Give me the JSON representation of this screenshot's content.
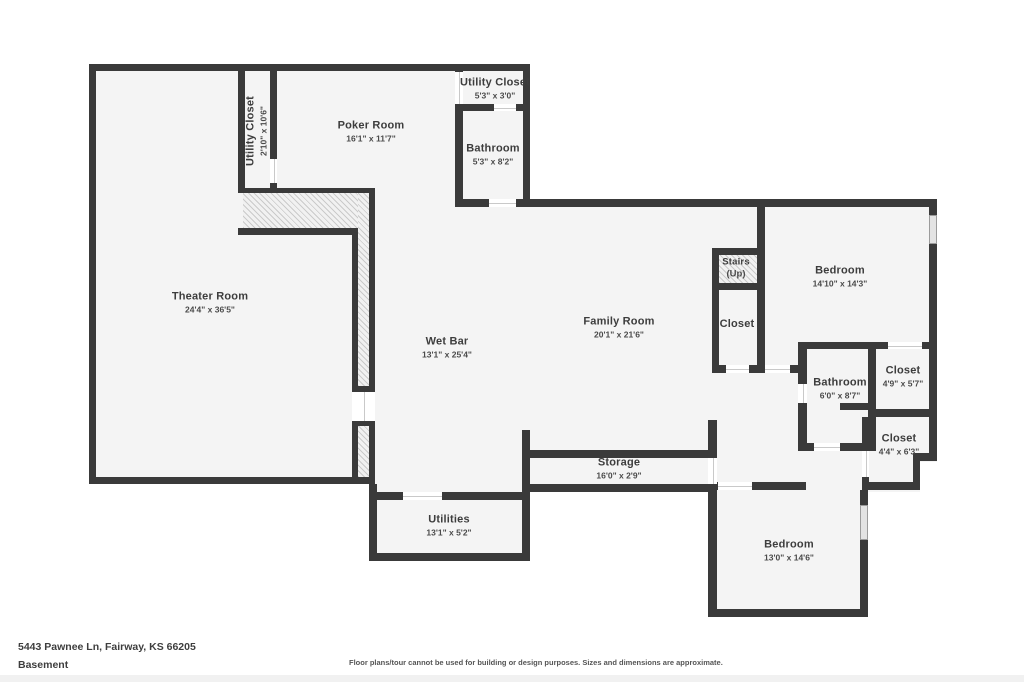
{
  "rooms": [
    {
      "name": "Theater Room",
      "dims": "24'4\" x 36'5\""
    },
    {
      "name": "Utility Closet",
      "dims": "2'10\" x 10'6\""
    },
    {
      "name": "Poker Room",
      "dims": "16'1\" x 11'7\""
    },
    {
      "name": "Utility Closet",
      "dims": "5'3\" x 3'0\""
    },
    {
      "name": "Bathroom",
      "dims": "5'3\" x 8'2\""
    },
    {
      "name": "Wet Bar",
      "dims": "13'1\" x 25'4\""
    },
    {
      "name": "Family Room",
      "dims": "20'1\" x 21'6\""
    },
    {
      "name": "Stairs",
      "dims": "(Up)"
    },
    {
      "name": "Closet",
      "dims": ""
    },
    {
      "name": "Bedroom",
      "dims": "14'10\" x 14'3\""
    },
    {
      "name": "Bathroom",
      "dims": "6'0\" x 8'7\""
    },
    {
      "name": "Closet",
      "dims": "4'9\" x 5'7\""
    },
    {
      "name": "Closet",
      "dims": "4'4\" x 6'3\""
    },
    {
      "name": "Storage",
      "dims": "16'0\" x 2'9\""
    },
    {
      "name": "Utilities",
      "dims": "13'1\" x 5'2\""
    },
    {
      "name": "Bedroom",
      "dims": "13'0\" x 14'6\""
    }
  ],
  "footer": {
    "address": "5443 Pawnee Ln, Fairway, KS 66205",
    "level": "Basement",
    "disclaimer": "Floor plans/tour cannot be used for building or design purposes. Sizes and dimensions are approximate."
  },
  "colors": {
    "wall": "#3a3a3a",
    "floor": "#f4f4f4",
    "background": "#ffffff"
  }
}
